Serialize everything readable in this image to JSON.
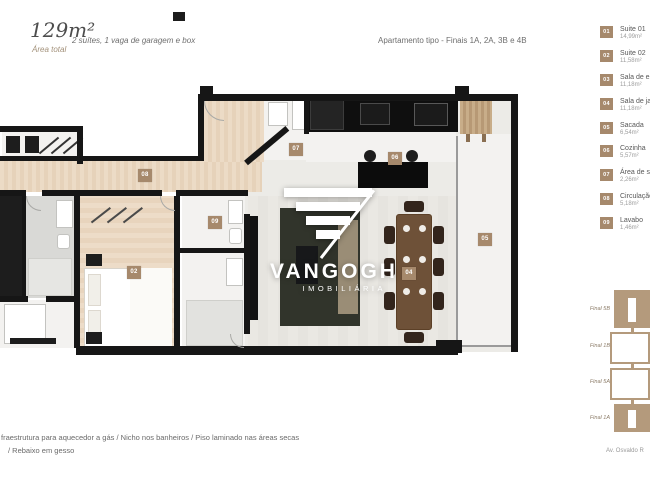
{
  "header": {
    "area_value": "129m²",
    "area_label": "Área total",
    "features": "2 suítes, 1 vaga de garagem e box",
    "unit_type": "Apartamento tipo - Finais 1A, 2A, 3B e 4B"
  },
  "watermark": {
    "brand": "VANGOGH",
    "tagline": "IMOBILIÁRIA"
  },
  "legend": {
    "items": [
      {
        "num": "01",
        "label": "Suite 01",
        "area": "14,99m²"
      },
      {
        "num": "02",
        "label": "Suite 02",
        "area": "11,58m²"
      },
      {
        "num": "03",
        "label": "Sala de estar",
        "area": "11,18m²"
      },
      {
        "num": "04",
        "label": "Sala de jantar",
        "area": "11,18m²"
      },
      {
        "num": "05",
        "label": "Sacada",
        "area": "6,54m²"
      },
      {
        "num": "06",
        "label": "Cozinha",
        "area": "5,57m²"
      },
      {
        "num": "07",
        "label": "Área de serviço",
        "area": "2,26m²"
      },
      {
        "num": "08",
        "label": "Circulação",
        "area": "5,18m²"
      },
      {
        "num": "09",
        "label": "Lavabo",
        "area": "1,46m²"
      }
    ]
  },
  "plan_markers": [
    {
      "num": "08"
    },
    {
      "num": "07"
    },
    {
      "num": "06"
    },
    {
      "num": "09"
    },
    {
      "num": "02"
    },
    {
      "num": "04"
    },
    {
      "num": "05"
    }
  ],
  "keyplan": {
    "labels": [
      "Final 5B",
      "Final 1B",
      "Final 5A",
      "Final 1A"
    ]
  },
  "footer": {
    "line1": "fraestrutura para aquecedor a gás / Nicho nos banheiros / Piso laminado nas áreas secas",
    "line2": "/ Rebaixo em gesso",
    "address": "Av. Osvaldo R"
  },
  "colors": {
    "accent": "#a6896c",
    "wall": "#161616",
    "keyplan_tan": "#b49a7c"
  }
}
